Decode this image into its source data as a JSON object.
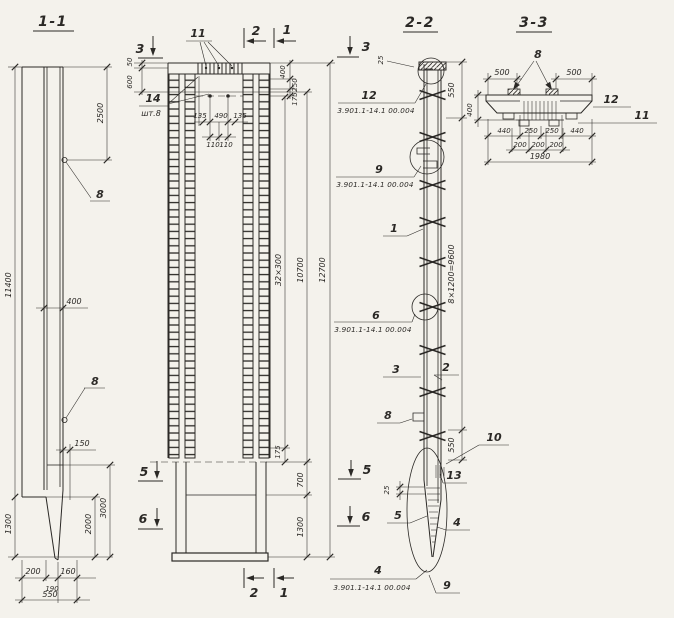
{
  "titles": {
    "s11": "1-1",
    "s22": "2-2",
    "s33": "3-3"
  },
  "marks": {
    "s1": "1",
    "s2": "2",
    "s3": "3",
    "s5": "5",
    "s6": "6"
  },
  "refs": {
    "series": "3.901.1-14.1 00.004"
  },
  "s11": {
    "d11400": "11400",
    "d2500": "2500",
    "loop": "8",
    "d400": "400",
    "d150": "150",
    "d3000": "3000",
    "d2000": "2000",
    "d1300": "1300",
    "d200": "200",
    "d190": "190",
    "d160": "160",
    "d550": "550"
  },
  "elev": {
    "l11": "11",
    "l14": "14",
    "l14_qty": "шт.8",
    "d50": "50",
    "d600": "600",
    "d135": "135",
    "d490": "490",
    "d110": "110",
    "d400": "400",
    "d250": "250",
    "d175": "175",
    "d_sp": "32×300",
    "d10700": "10700",
    "d12700": "12700",
    "d700": "700",
    "d1300": "1300"
  },
  "s22": {
    "c1": "1",
    "c2": "2",
    "c3": "3",
    "c4": "4",
    "c5": "5",
    "c6": "6",
    "c8": "8",
    "c9": "9",
    "c10": "10",
    "c12": "12",
    "c13": "13",
    "d25": "25",
    "d550": "550",
    "d_sp": "8×1200=9600"
  },
  "s33": {
    "c8": "8",
    "c11": "11",
    "c12": "12",
    "d500": "500",
    "d400": "400",
    "d440": "440",
    "d250": "250",
    "d200": "200",
    "d1980": "1980"
  }
}
